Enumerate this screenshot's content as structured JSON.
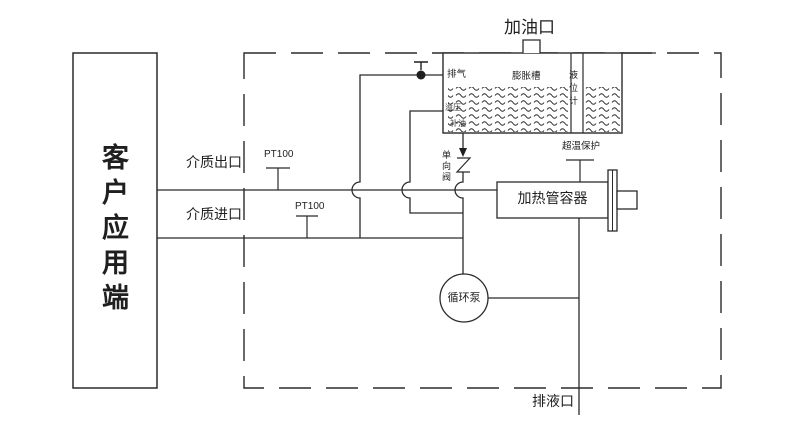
{
  "diagram": {
    "title_hint": "thermal-oil-heating-system-schematic",
    "customer_box": {
      "label": "客户应用端"
    },
    "fill_port": {
      "label": "加油口"
    },
    "expansion_tank": {
      "name": "膨胀槽",
      "vent": "排气",
      "level_gauge": "液位计",
      "relief": "溢压",
      "makeup": "补油"
    },
    "check_valve": {
      "label": "单向阀"
    },
    "heater": {
      "label": "加热管容器",
      "overtemp": "超温保护"
    },
    "pump": {
      "label": "循环泵"
    },
    "drain": {
      "label": "排液口"
    },
    "pipes": {
      "outlet": "介质出口",
      "inlet": "介质进口"
    },
    "sensors": {
      "pt100_outlet": "PT100",
      "pt100_inlet": "PT100"
    },
    "colors": {
      "line": "#2b2b2b",
      "text": "#1f1f1f",
      "background": "#ffffff"
    }
  }
}
